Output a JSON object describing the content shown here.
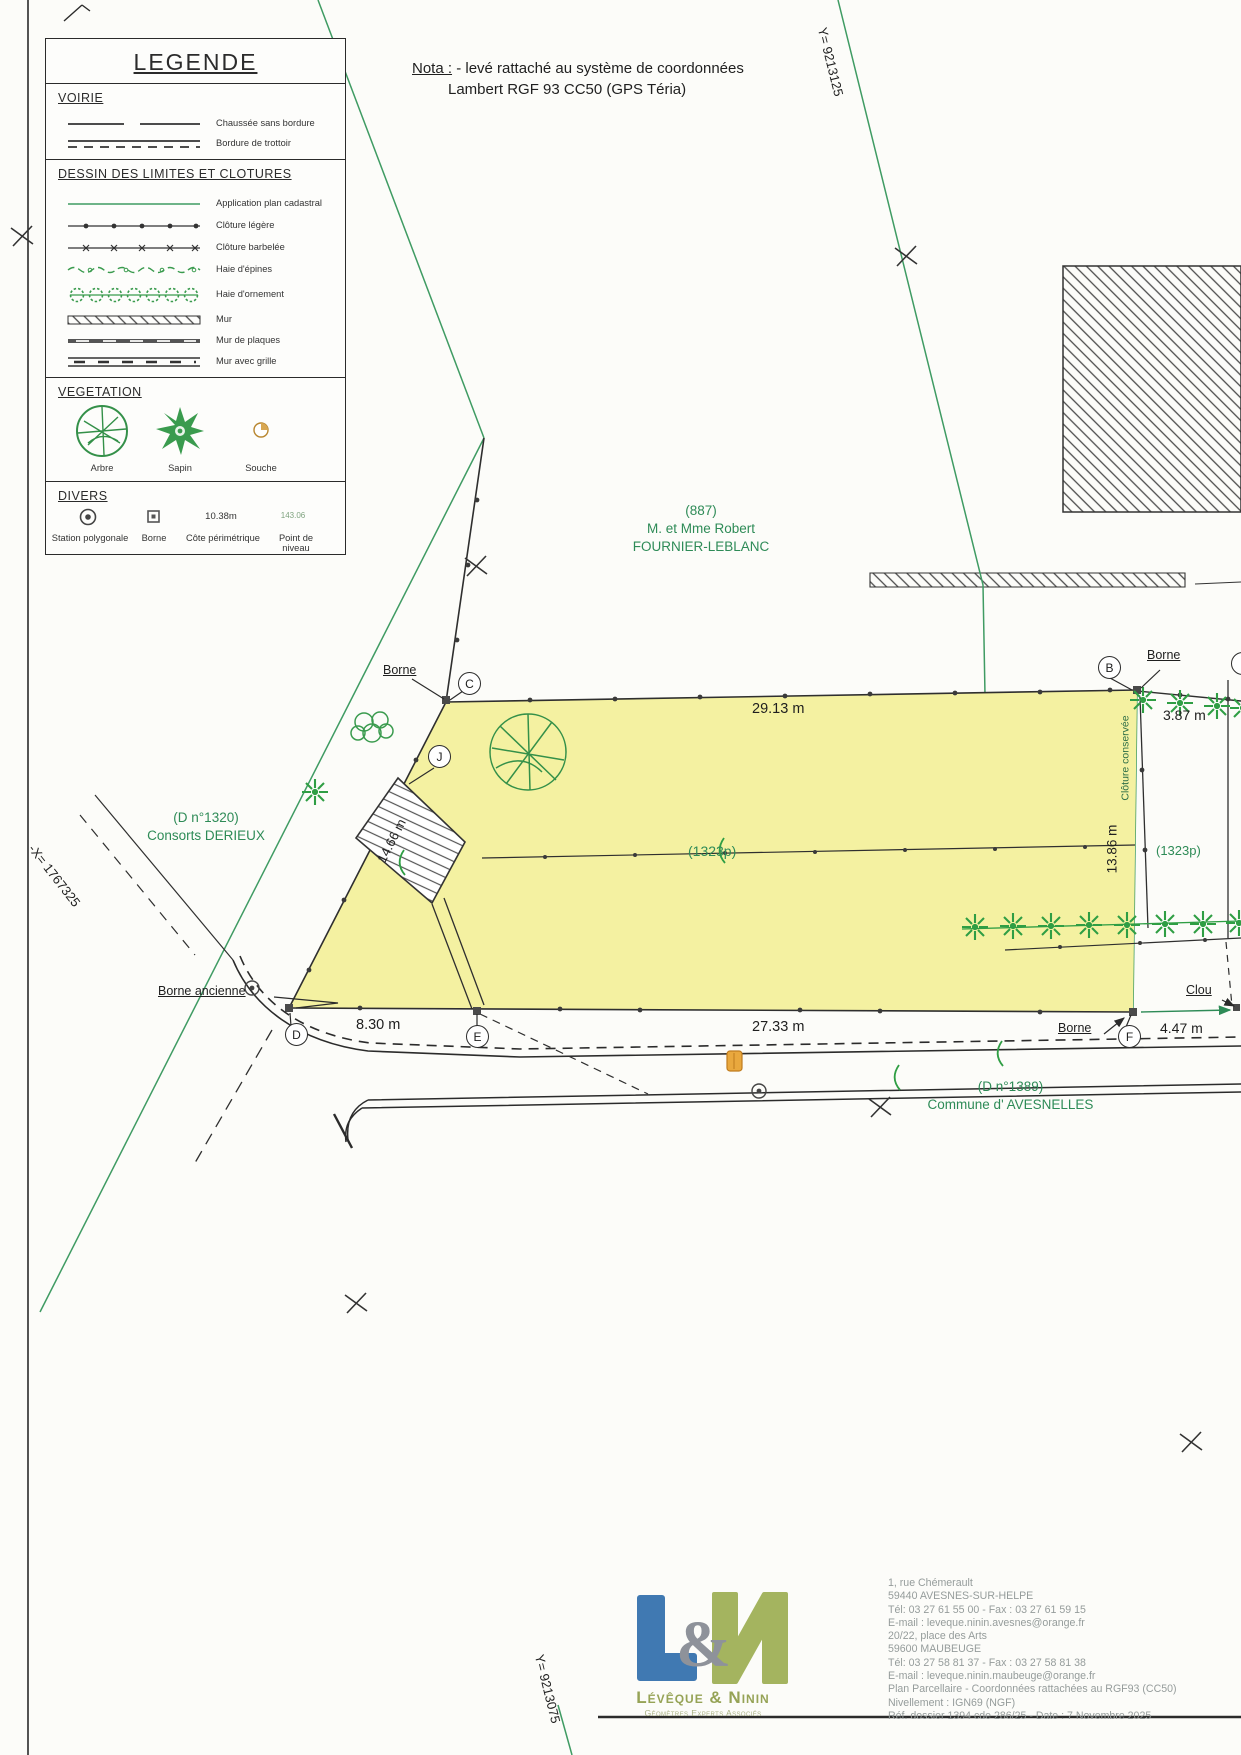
{
  "legend": {
    "title": "LEGENDE",
    "voirie": {
      "title": "VOIRIE",
      "items": [
        "Chaussée sans bordure",
        "Bordure de trottoir"
      ]
    },
    "limites": {
      "title": "DESSIN DES LIMITES ET CLOTURES",
      "items": [
        "Application plan cadastral",
        "Clôture légère",
        "Clôture barbelée",
        "Haie d'épines",
        "Haie d'ornement",
        "Mur",
        "Mur de plaques",
        "Mur avec grille"
      ]
    },
    "vegetation": {
      "title": "VEGETATION",
      "items": [
        "Arbre",
        "Sapin",
        "Souche"
      ]
    },
    "divers": {
      "title": "DIVERS",
      "items": [
        "Station polygonale",
        "Borne",
        "Côte périmétrique",
        "Point de niveau"
      ],
      "cote_value": "10.38m",
      "niveau_value": "143.06"
    }
  },
  "nota": {
    "label": "Nota :",
    "text": "- levé rattaché au système de coordonnées",
    "text2": "Lambert RGF 93 CC50 (GPS Téria)"
  },
  "grid": {
    "y_top": "Y= 9213125",
    "x_left": "-X= 1767325",
    "y_bottom": "Y= 9213075"
  },
  "parcels": {
    "p887_num": "(887)",
    "p887_owner1": "M. et Mme Robert",
    "p887_owner2": "FOURNIER-LEBLANC",
    "p1320_num": "(D n°1320)",
    "p1320_owner": "Consorts DERIEUX",
    "p1323": "(1323p)",
    "p1323_right": "(1323p)",
    "p1389_num": "(D n°1389)",
    "p1389_owner": "Commune d' AVESNELLES"
  },
  "dims": {
    "top": "29.13 m",
    "right_top": "3.87 m",
    "right": "13.86 m",
    "left": "14.66 m",
    "bottom_left": "8.30 m",
    "bottom_mid": "27.33 m",
    "bottom_right": "4.47 m"
  },
  "marks": {
    "borne_tl": "Borne",
    "borne_tr": "Borne",
    "borne_br": "Borne",
    "borne_ancienne": "Borne ancienne",
    "clou": "Clou",
    "cloture": "Clôture conservée"
  },
  "points": {
    "b": "B",
    "c": "C",
    "d": "D",
    "e": "E",
    "f": "F",
    "j": "J"
  },
  "colors": {
    "parcel_yellow": "#f4f1a1",
    "plan_green": "#2e8b57",
    "hedge_green": "#2f9e44",
    "ink": "#2b2b2b"
  },
  "footer": {
    "company": "Lévêque & Ninin",
    "company_sub": "Géomètres Experts Associés",
    "ampersand": "&",
    "lines": [
      "1, rue Chémerault",
      "59440 AVESNES-SUR-HELPE",
      "Tél: 03 27 61 55 00 - Fax : 03 27 61 59 15",
      "E-mail : leveque.ninin.avesnes@orange.fr",
      "20/22, place des Arts",
      "59600 MAUBEUGE",
      "Tél: 03 27 58 81 37 - Fax : 03 27 58 81 38",
      "E-mail : leveque.ninin.maubeuge@orange.fr",
      "Plan Parcellaire - Coordonnées rattachées au RGF93 (CC50)",
      "Nivellement : IGN69 (NGF)",
      "Réf. dossier 1394 cde 286/25 - Date : 7 Novembre 2025"
    ]
  }
}
